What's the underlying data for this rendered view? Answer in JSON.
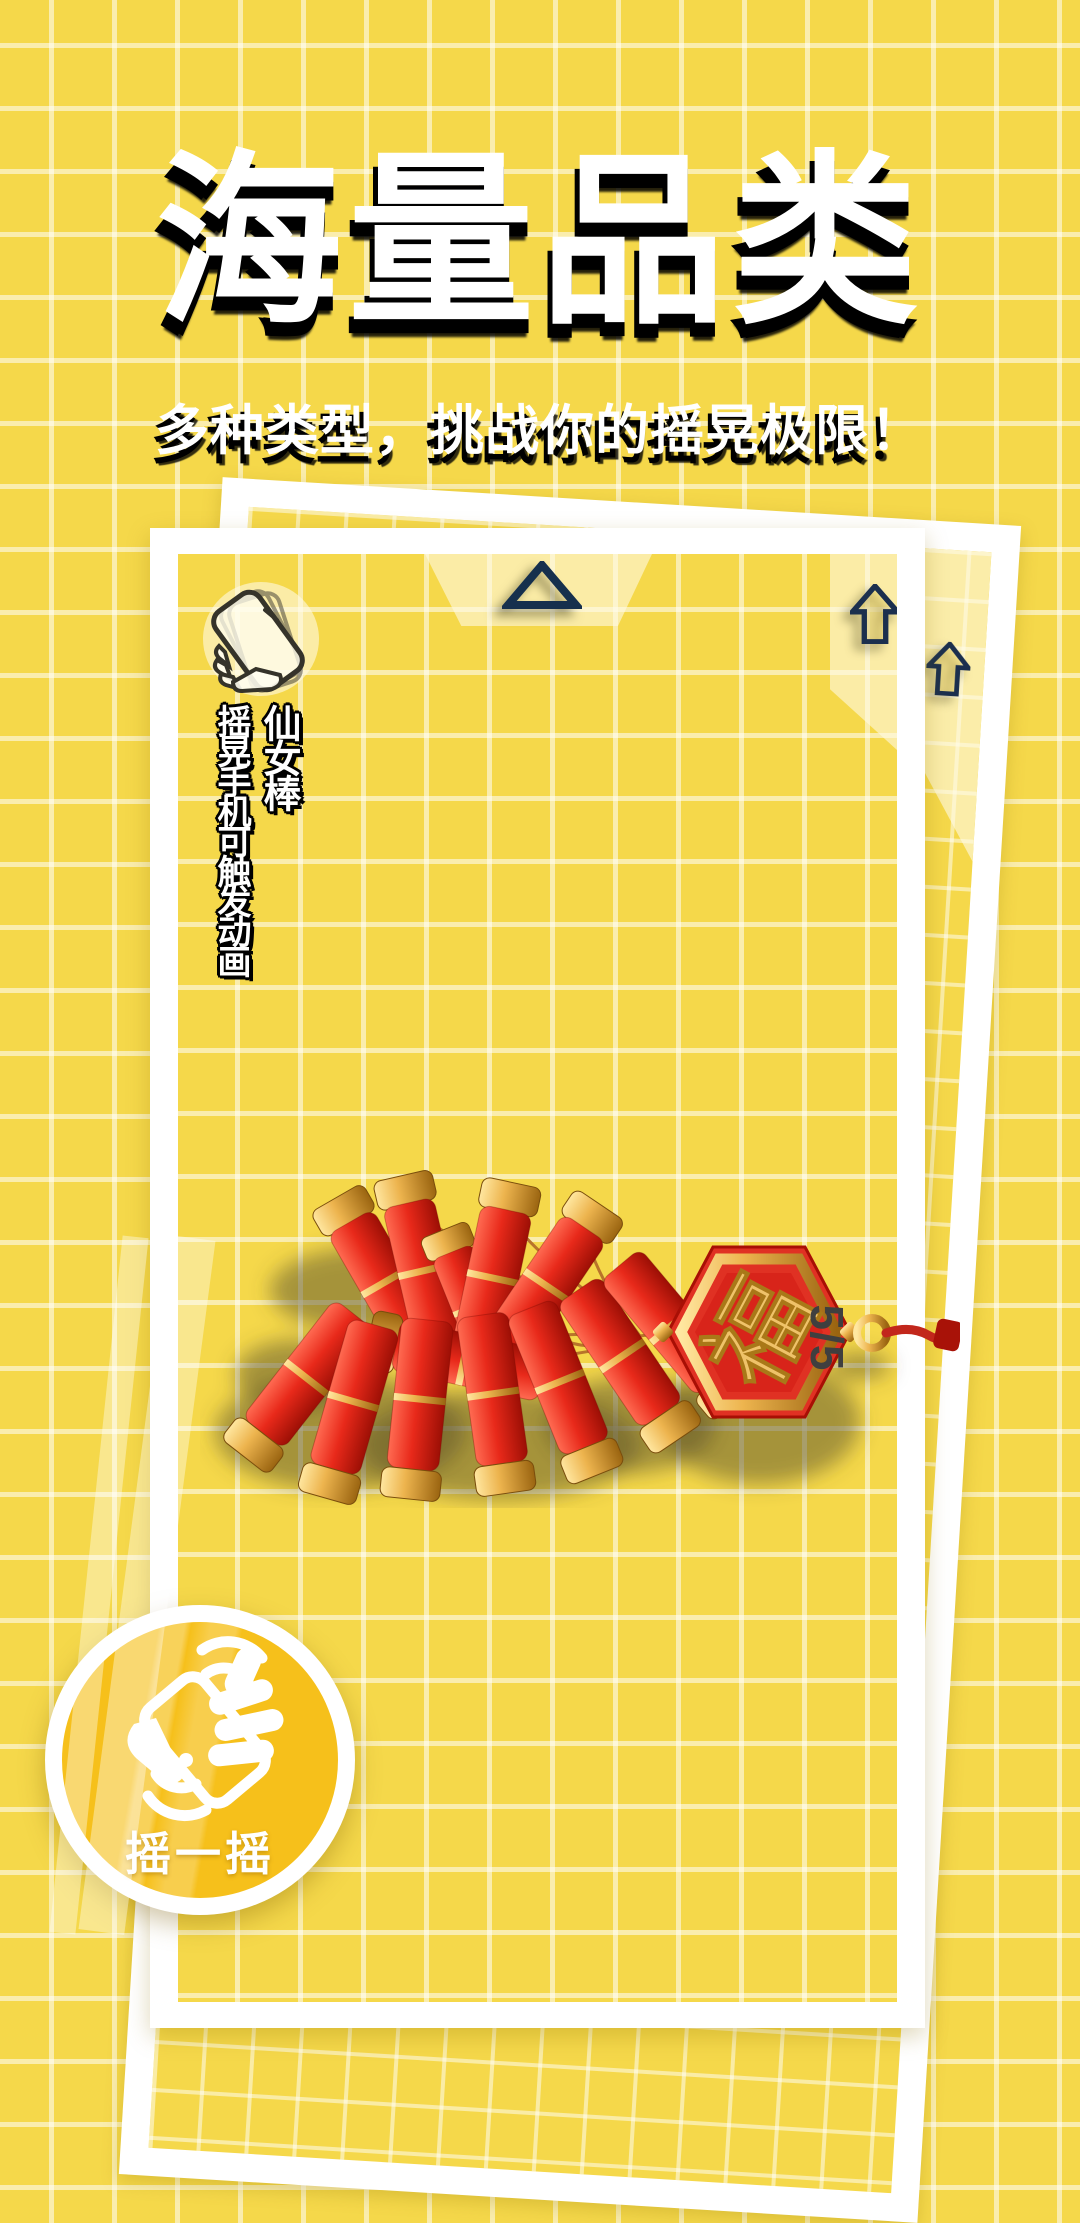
{
  "page": {
    "title": "海量品类",
    "subtitle": "多种类型，挑战你的摇晃极限！"
  },
  "card": {
    "item_name": "仙女棒",
    "item_hint": "摇晃手机可触发动画",
    "counter": "5/5",
    "pendant_char": "福"
  },
  "badge": {
    "label": "摇一摇"
  },
  "icons": {
    "shake_phone": "shake-phone-icon",
    "up_triangle": "up-triangle-icon",
    "up_arrow": "up-arrow-icon",
    "shake_hands": "shake-hands-icon"
  },
  "colors": {
    "background": "#F5D84A",
    "grid_line": "rgba(255,255,255,0.55)",
    "navy": "#1B2F4E",
    "badge_fill": "#F6C01B",
    "firecracker_red": "#E02C1E",
    "gold": "#E8B54A",
    "counter_text": "#3F3F3F",
    "title_text": "#FFFFFF",
    "title_shadow": "#000000"
  }
}
